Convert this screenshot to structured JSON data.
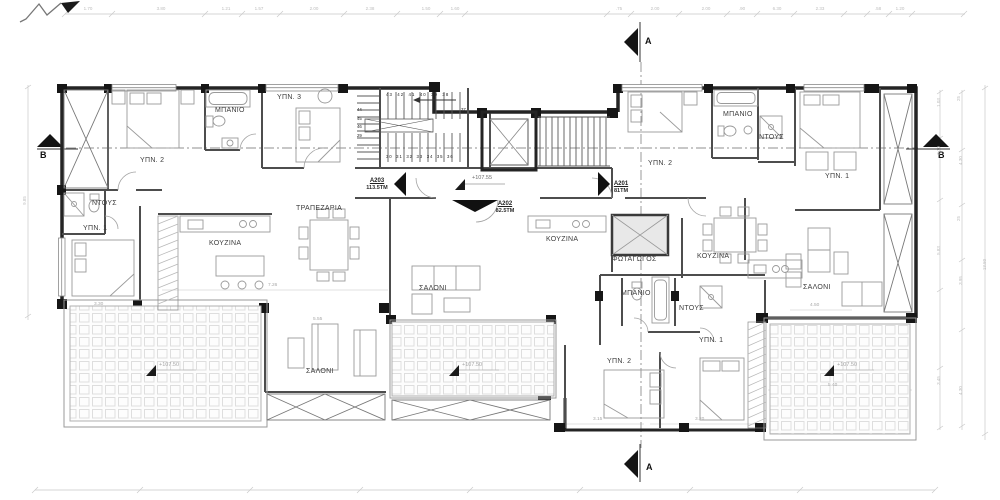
{
  "section_markers": {
    "top": "A",
    "bottom": "A",
    "left": "B",
    "right": "B"
  },
  "apartments": {
    "left": {
      "id": "A203",
      "area": "113.5TM"
    },
    "middle": {
      "id": "A202",
      "area": "82.5TM"
    },
    "right": {
      "id": "A201",
      "area": "81TM"
    }
  },
  "rooms": {
    "left": {
      "bedroom2": "ΥΠΝ. 2",
      "bathroom": "ΜΠΑΝΙΟ",
      "bedroom3": "ΥΠΝ. 3",
      "shower": "ΝΤΟΥΣ",
      "bedroom1": "ΥΠΝ. 1",
      "kitchen": "ΚΟΥΖΙΝΑ",
      "dining": "ΤΡΑΠΕΖΑΡΙΑ",
      "living": "ΣΑΛΟΝΙ"
    },
    "middle": {
      "kitchen": "ΚΟΥΖΙΝΑ",
      "living": "ΣΑΛΟΝΙ",
      "lightwell": "ΦΩΤΑΓΩΓΟΣ",
      "bathroom": "ΜΠΑΝΙΟ",
      "shower": "ΝΤΟΥΣ",
      "bedroom1": "ΥΠΝ. 1",
      "bedroom2": "ΥΠΝ. 2"
    },
    "right": {
      "bedroom2": "ΥΠΝ. 2",
      "bathroom": "ΜΠΑΝΙΟ",
      "shower": "ΝΤΟΥΣ",
      "bedroom1": "ΥΠΝ. 1",
      "kitchen": "ΚΟΥΖΙΝΑ",
      "living": "ΣΑΛΟΝΙ"
    }
  },
  "elevations": {
    "corridor": "+107.55",
    "balcony_left": "+107.50",
    "balcony_middle": "+107.50",
    "balcony_right": "+107.50"
  },
  "stairs": {
    "top_row": "43 42 41 40 39 38",
    "num_37": "37",
    "bottom_row": "30 31 32 33 34 35 36",
    "side": [
      "44",
      "45",
      "46",
      "29"
    ]
  },
  "dimensions": {
    "top": [
      "1.70",
      "3.80",
      "1.21",
      "1.57",
      "2.00",
      "2.38",
      "1.50",
      "1.60",
      ".75",
      "2.00",
      "2.00",
      ".90",
      "6.30",
      "2.33",
      ".58",
      "1.20"
    ],
    "right": [
      "1.03",
      "3.10",
      "5.83",
      "3.45",
      "25",
      "4.30",
      "25",
      "3.95",
      "4.30",
      "13.50"
    ],
    "left": "9.85",
    "plan": {
      "left_wing": "3.30",
      "living": "7.26",
      "balcony_left": "5.55",
      "living_right": "4.50",
      "balcony_right": "5.40",
      "bed_mid_a": "3.15",
      "bed_mid_b": "3.20"
    }
  },
  "colors": {
    "line": "#2a2a2a",
    "wall": "#161616",
    "tile": "#dedede",
    "dim": "#bdbdbd",
    "text": "#3c3c3c"
  }
}
